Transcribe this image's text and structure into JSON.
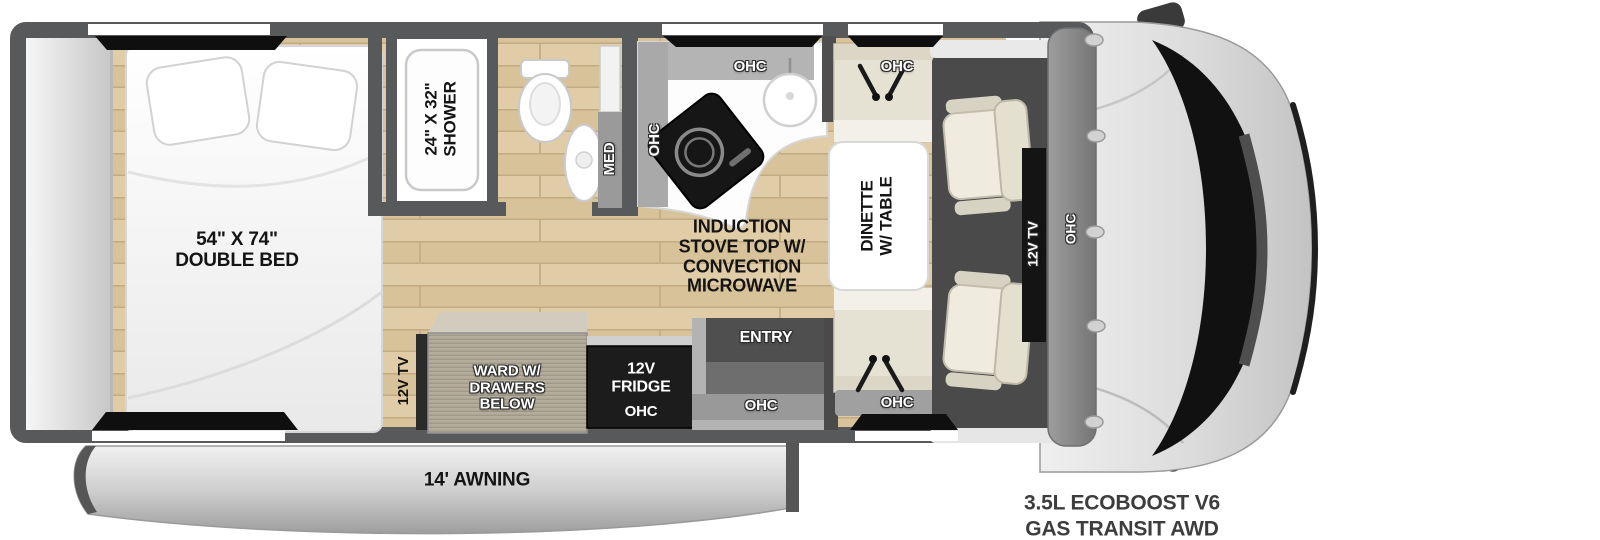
{
  "labels": {
    "bedroom": {
      "bed_line1": "54\" X 74\"",
      "bed_line2": "DOUBLE BED",
      "tv": "12V TV"
    },
    "bathroom": {
      "shower_line1": "24\" X 32\"",
      "shower_line2": "SHOWER",
      "med": "MED"
    },
    "kitchen": {
      "ohc_side": "OHC",
      "ohc_top": "OHC",
      "stove_line1": "INDUCTION",
      "stove_line2": "STOVE TOP W/",
      "stove_line3": "CONVECTION",
      "stove_line4": "MICROWAVE"
    },
    "dinette": {
      "table_line1": "DINETTE",
      "table_line2": "W/ TABLE",
      "ohc_top": "OHC",
      "ohc_bottom": "OHC"
    },
    "galley": {
      "ward_line1": "WARD W/",
      "ward_line2": "DRAWERS",
      "ward_line3": "BELOW",
      "fridge_line1": "12V",
      "fridge_line2": "FRIDGE",
      "fridge_ohc": "OHC",
      "entry": "ENTRY",
      "entry_ohc": "OHC"
    },
    "cab": {
      "tv": "12V TV",
      "ohc": "OHC"
    },
    "exterior": {
      "awning": "14' AWNING",
      "engine_line1": "3.5L ECOBOOST V6",
      "engine_line2": "GAS TRANSIT AWD"
    }
  },
  "colors": {
    "wall": "#58595b",
    "wood_light": "#e0cda7",
    "wood_dark": "#d7c299",
    "appliance_black": "#161616",
    "cabinet_gray": "#adadad",
    "cab_body": "#d9d9d9",
    "awning_gray": "#c7c7c7",
    "text_dark": "#141414"
  }
}
